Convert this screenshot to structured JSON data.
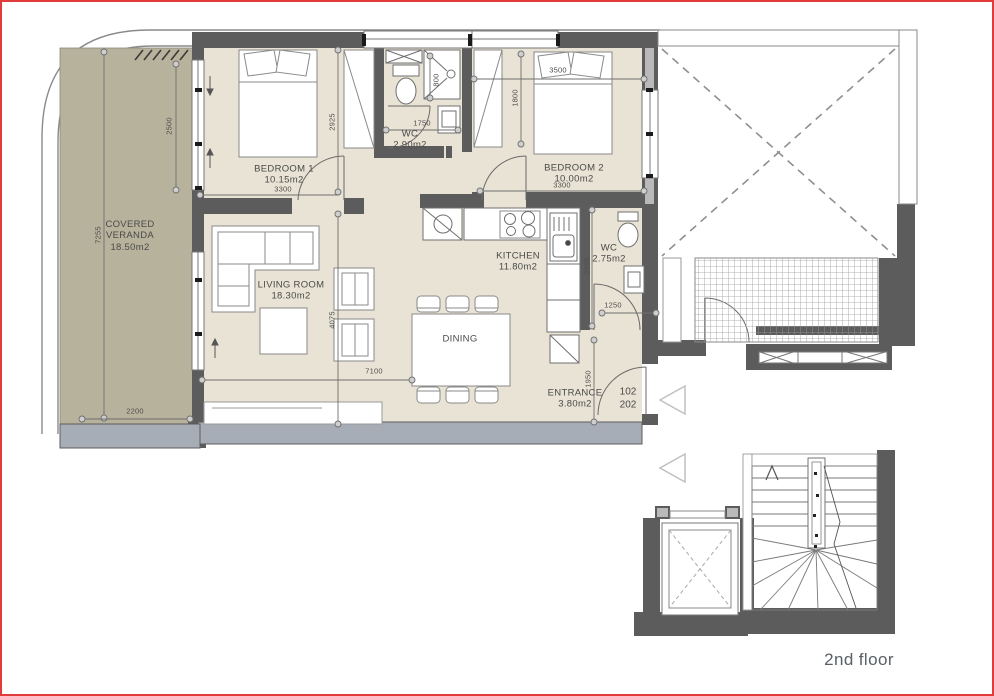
{
  "floor": {
    "label": "2nd floor"
  },
  "rooms": {
    "veranda": {
      "line1": "COVERED",
      "line2": "VERANDA",
      "area": "18.50m2"
    },
    "bedroom1": {
      "name": "BEDROOM 1",
      "area": "10.15m2"
    },
    "wc1": {
      "name": "WC",
      "area": "2.90m2"
    },
    "bedroom2": {
      "name": "BEDROOM 2",
      "area": "10.00m2"
    },
    "living": {
      "name": "LIVING ROOM",
      "area": "18.30m2"
    },
    "kitchen": {
      "name": "KITCHEN",
      "area": "11.80m2"
    },
    "wc2": {
      "name": "WC",
      "area": "2.75m2"
    },
    "dining": {
      "name": "DINING"
    },
    "entrance": {
      "name": "ENTRANCE",
      "area": "3.80m2"
    }
  },
  "units": {
    "unit1": "102",
    "unit2": "202"
  },
  "dims": {
    "veranda_height": "7255",
    "veranda_window": "2500",
    "veranda_width": "2200",
    "bedroom1_height": "2925",
    "bedroom1_width": "3300",
    "wc1_width": "1750",
    "shower_width": "800",
    "bedroom2_top": "3500",
    "bedroom2_depth": "1800",
    "bedroom2_width": "3300",
    "living_height": "4075",
    "living_width": "7100",
    "kitchen_depth": "2325",
    "wc2_door": "1250",
    "entrance_depth": "1950"
  },
  "colors": {
    "floor": "#e8e3d4",
    "veranda": "#b6b29c",
    "wall_dark": "#5c5c5c",
    "wall_blue": "#a7adb6",
    "border": "#e23b3b"
  }
}
